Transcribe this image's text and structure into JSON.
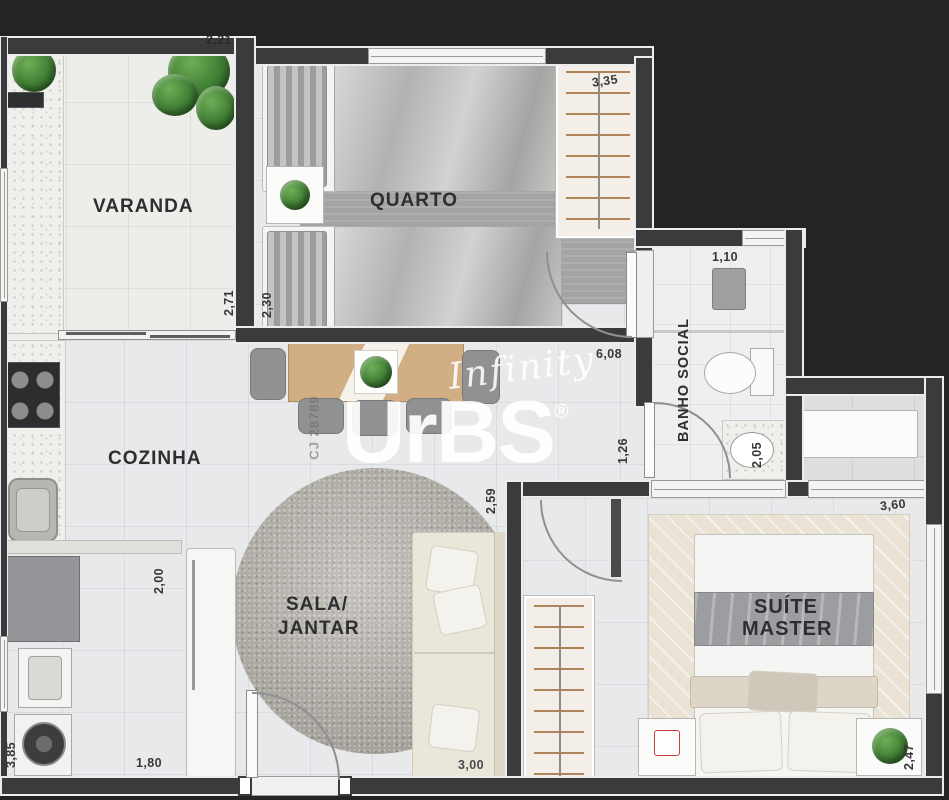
{
  "plan": {
    "rooms": {
      "varanda": "VARANDA",
      "quarto": "QUARTO",
      "banho_social": "BANHO SOCIAL",
      "cozinha": "COZINHA",
      "sala_line1": "SALA/",
      "sala_line2": "JANTAR",
      "suite_line1": "SUÍTE",
      "suite_line2": "MASTER"
    },
    "dimensions": {
      "varanda_width": "2,21",
      "varanda_depth": "2,71",
      "quarto_depth": "2,30",
      "closet_wall": "3,35",
      "banho_width": "1,10",
      "hall_length": "6,08",
      "hall_width": "1,26",
      "banho_depth": "2,05",
      "sala_width": "2,59",
      "cozinha_depth": "2,00",
      "servico_depth": "3,85",
      "servico_width": "1,80",
      "sala_length": "3,00",
      "suite_width": "3,60",
      "suite_depth": "2,47"
    },
    "watermark": {
      "script": "Infinity",
      "brand": "UrBS",
      "registered": "®",
      "code": "CJ 28789"
    },
    "colors": {
      "background": "#242426",
      "wall": "#3a3b3d",
      "floor": "#e8e9eb",
      "wood": "#d2ae85",
      "rug_gray": "#a8a8a8",
      "rug_round": "#b2aea7",
      "rug_suite": "#eae3d5",
      "plant_green": "#3f7d33",
      "label_text": "#2d2e30"
    }
  }
}
